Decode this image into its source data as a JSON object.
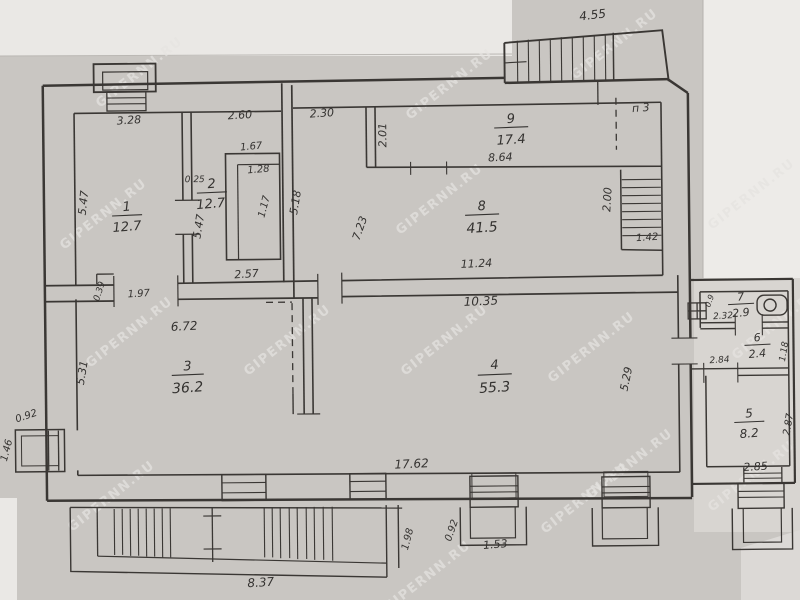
{
  "watermark": {
    "text": "GIPERNN.RU"
  },
  "colors": {
    "paper": "#c9c6c2",
    "paper_light": "#eae8e5",
    "paper_white": "#edebe8",
    "paper_annex": "#d8d5d1",
    "ink": "#3a3734",
    "watermark": "#e6e4e1"
  },
  "rooms": {
    "r1": {
      "number": "1",
      "area": "12.7"
    },
    "r2": {
      "number": "2",
      "area": "12.7"
    },
    "r3": {
      "number": "3",
      "area": "36.2"
    },
    "r4": {
      "number": "4",
      "area": "55.3"
    },
    "r5": {
      "number": "5",
      "area": "8.2"
    },
    "r6": {
      "number": "6",
      "area": "2.4"
    },
    "r7": {
      "number": "7",
      "area": "2.9"
    },
    "r8": {
      "number": "8",
      "area": "41.5"
    },
    "r9": {
      "number": "9",
      "area": "17.4"
    }
  },
  "dims": {
    "stairs_top": "4.55",
    "p3": "п 3",
    "r1_top": "3.28",
    "r2_top": "2.60",
    "r8_top": "2.30",
    "r9_left": "2.01",
    "r9_bottom": "8.64",
    "closet_top": "1.67",
    "closet_inner": "1.28",
    "r2_nook": "0.25",
    "r1_left": "5.47",
    "r2_mid": "5.47",
    "r2_right": "1.17",
    "r8_left": "5.18",
    "r2_bottom": "2.57",
    "r1_nook": "0.39",
    "r1_door": "1.97",
    "r8_mid": "7.23",
    "stairs_right_width": "2.00",
    "stairs_right_bottom": "1.42",
    "r8_bottom": "11.24",
    "r4_top": "10.35",
    "r3_top": "6.72",
    "r3_left": "5.31",
    "r4_right": "5.29",
    "r7_width": "2.32",
    "r7_nook": "0.9",
    "r6_width": "2.84",
    "r6_right": "1.18",
    "r5_right": "2.87",
    "r5_bottom": "2.85",
    "r4_bottom": "17.62",
    "porch_mid_depth": "0.92",
    "porch_mid_width": "1.53",
    "stairs_bottom_right": "1.98",
    "stairs_bottom_width": "8.37",
    "porch_left_depth": "0.92",
    "porch_left_width": "1.46"
  }
}
